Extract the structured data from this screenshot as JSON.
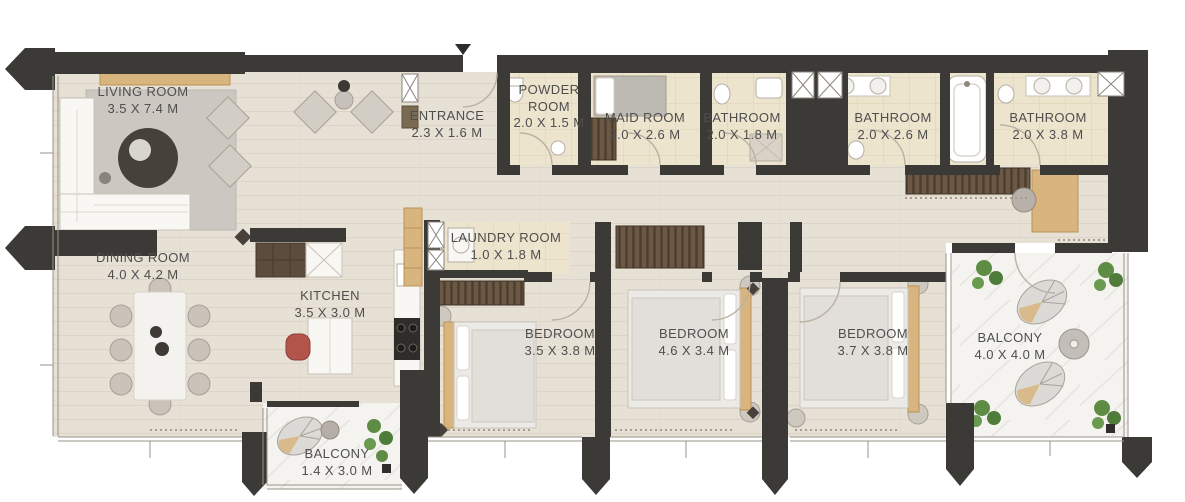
{
  "plan": {
    "type": "apartment-floor-plan",
    "entrance_marker_icon": "down-triangle",
    "colors": {
      "wall": "#3b3a37",
      "wood_floor": "#e7e0d5",
      "tile_floor": "#ece4cd",
      "balcony_floor": "#f4f3f0",
      "label_text": "#4e4e4e",
      "accent_wood": "#d8b47e",
      "wardrobe_brown": "#6b5845",
      "chair_red": "#b2544a",
      "plant_green": "#5e8c45"
    },
    "rooms": [
      {
        "name": "LIVING ROOM",
        "dims": "3.5 X 7.4 M"
      },
      {
        "name": "ENTRANCE",
        "dims": "2.3 X 1.6 M"
      },
      {
        "name": "POWDER ROOM",
        "dims": "2.0 X 1.5 M"
      },
      {
        "name": "MAID ROOM",
        "dims": "2.0 X 2.6 M"
      },
      {
        "name": "BATHROOM",
        "dims": "2.0 X 1.8 M"
      },
      {
        "name": "BATHROOM",
        "dims": "2.0 X 2.6 M"
      },
      {
        "name": "BATHROOM",
        "dims": "2.0 X 3.8 M"
      },
      {
        "name": "DINING ROOM",
        "dims": "4.0 X 4.2 M"
      },
      {
        "name": "KITCHEN",
        "dims": "3.5 X 3.0 M"
      },
      {
        "name": "LAUNDRY ROOM",
        "dims": "1.0 X 1.8 M"
      },
      {
        "name": "BEDROOM",
        "dims": "3.5 X 3.8 M"
      },
      {
        "name": "BEDROOM",
        "dims": "4.6 X 3.4 M"
      },
      {
        "name": "BEDROOM",
        "dims": "3.7 X 3.8 M"
      },
      {
        "name": "BALCONY",
        "dims": "4.0 X 4.0 M"
      },
      {
        "name": "BALCONY",
        "dims": "1.4 X 3.0 M"
      }
    ]
  }
}
